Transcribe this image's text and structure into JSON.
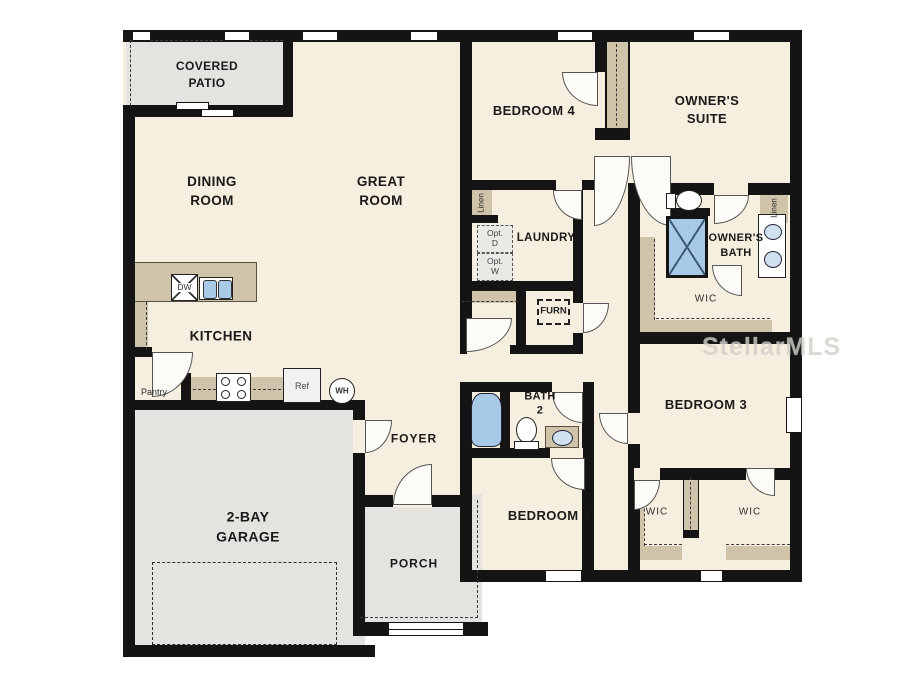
{
  "watermark": "StellarMLS",
  "colors": {
    "wall": "#141414",
    "floor": "#f6eede",
    "hardscape": "#e4e3e0",
    "counter": "#cfc3a9",
    "fixture_blue": "#a9c9e9",
    "watermark_color": "#d3d0ca"
  },
  "rooms": {
    "covered_patio": "COVERED\nPATIO",
    "dining_room": "DINING\nROOM",
    "great_room": "GREAT\nROOM",
    "bedroom_4": "BEDROOM 4",
    "owners_suite": "OWNER'S\nSUITE",
    "laundry": "LAUNDRY",
    "owners_bath": "OWNER'S\nBATH",
    "owners_wic": "WIC",
    "kitchen": "KITCHEN",
    "pantry": "Pantry",
    "bath_2": "BATH\n2",
    "foyer": "FOYER",
    "bedroom_2": "BEDROOM 2",
    "bedroom_3": "BEDROOM 3",
    "wic_bedroom_2": "WIC",
    "wic_bedroom_3": "WIC",
    "garage": "2-BAY\nGARAGE",
    "porch": "PORCH"
  },
  "closets": {
    "linen_hall": "Linen",
    "linen_owners_bath": "Linen"
  },
  "appliances": {
    "dishwasher": "DW",
    "refrigerator": "Ref",
    "water_heater": "WH",
    "furnace": "FURN",
    "optional_dryer": "Opt.\nD",
    "optional_washer": "Opt.\nW"
  }
}
